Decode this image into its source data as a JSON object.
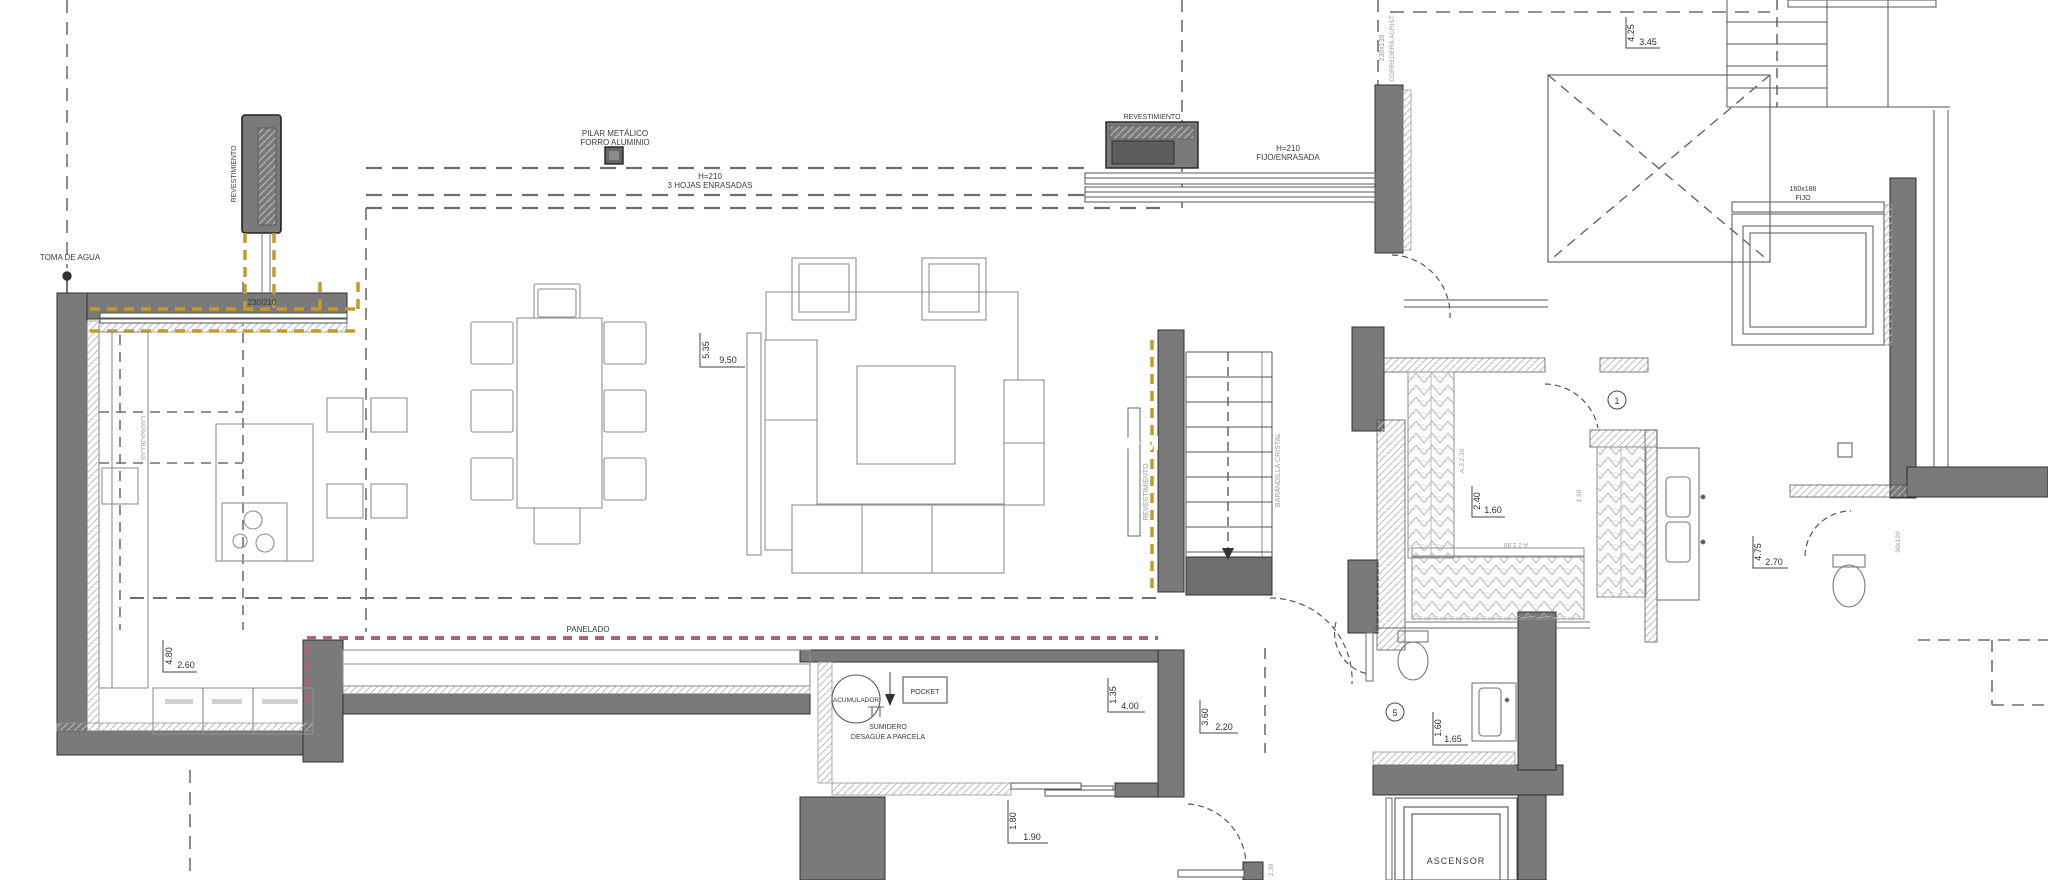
{
  "document": {
    "type": "architectural-floor-plan",
    "colors": {
      "wall_gray": "#7a7a7a",
      "wall_dark": "#5d5d5d",
      "beam_yellow": "#c49b27",
      "panel_pink": "#b26080",
      "line_gray": "#555555"
    }
  },
  "texts": {
    "toma_de_agua": "TOMA DE AGUA",
    "revestimiento_chimenea": "REVESTIMIENTO",
    "pilar_l1": "PILAR METÁLICO",
    "pilar_l2": "FORRO ALUMINIO",
    "ventanal_l1": "H=210",
    "ventanal_l2": "3 HOJAS ENRASADAS",
    "dim_230_210": "230/210",
    "lavavajillas": "LAVAVAJILLAS",
    "panelado": "PANELADO",
    "revestimiento_banco": "REVESTIMIENTO",
    "fijo_l1": "H=210",
    "fijo_l2": "FIJO/ENRASADA",
    "revestimiento_escalera": "REVESTIMIENTO",
    "barandilla_cristal": "BARANDILLA CRISTAL",
    "corredera_l1": "230x130",
    "corredera_l2": "CORREDERA ACRIST.",
    "fijo_ventana_l1": "160x186",
    "fijo_ventana_l2": "FIJO",
    "ascensor": "ASCENSOR",
    "acumulador": "ACUMULADOR",
    "pocket": "POCKET",
    "sumidero_l1": "SUMIDERO",
    "sumidero_l2": "DESAGÜE A PARCELA",
    "num_puerta_1": "1",
    "num_puerta_5": "5",
    "ref_a3": "A-3 2.30",
    "ref_a2": "A-2 1.80",
    "ref_130": "1.30",
    "ref_90x120": "90x120",
    "ref_230v": "2.30",
    "watermark": "COM",
    "d535": "5.35",
    "d950": "9.50",
    "d480": "4.80",
    "d260": "2.60",
    "d425": "4.25",
    "d345": "3.45",
    "d240": "2.40",
    "d160": "1.60",
    "d475": "4.75",
    "d270": "2.70",
    "d160b": "1.60",
    "d165": "1.65",
    "d135": "1.35",
    "d400": "4.00",
    "d360": "3.60",
    "d220": "2.20",
    "d180": "1.80",
    "d190": "1.90"
  }
}
